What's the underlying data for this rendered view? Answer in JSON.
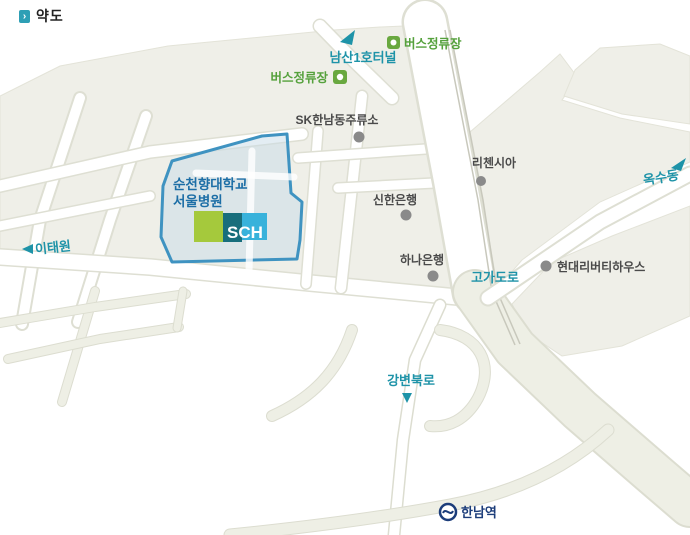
{
  "header": {
    "title": "약도"
  },
  "map": {
    "hospital": {
      "line1": "순천향대학교",
      "line2": "서울병원",
      "logo": "SCH"
    },
    "roads": {
      "namsan_tunnel": "남산1호터널",
      "overpass": "고가도로",
      "gangbyeon_expressway": "강변북로",
      "itaewon": "이태원",
      "oksu_dong": "옥수동"
    },
    "places": {
      "bus_stop_top": "버스정류장",
      "bus_stop_left": "버스정류장",
      "sk_station": "SK한남동주류소",
      "shinhan_bank": "신한은행",
      "hana_bank": "하나은행",
      "richensia": "리첸시아",
      "hyundai_liberty_house": "현대리버티하우스",
      "hannam_station": "한남역"
    },
    "colors": {
      "land": "#EFEFE8",
      "road_label_teal": "#1E93A8",
      "bus_green": "#55A13C",
      "hospital_text_blue": "#1C6EA6",
      "hospital_outline_blue": "#3F93C1",
      "logo_green": "#A5C93C",
      "logo_dark_teal": "#186E7C",
      "logo_cyan": "#38B2DB",
      "station_navy": "#1C3D7A",
      "poi_dot_gray": "#8A8A8A",
      "poi_text_gray": "#4A4A4A"
    }
  }
}
